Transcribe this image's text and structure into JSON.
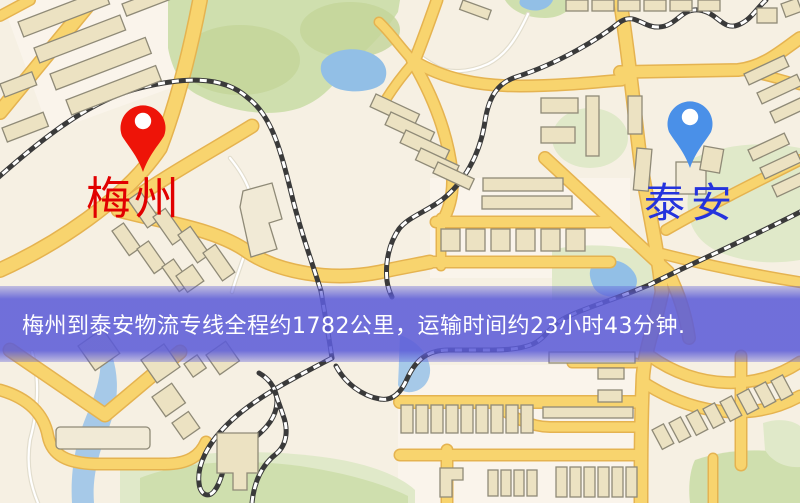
{
  "banner": {
    "text": "梅州到泰安物流专线全程约1782公里，运输时间约23小时43分钟.",
    "background_color": "#5c5cd8",
    "text_color": "#ffffff"
  },
  "markers": {
    "origin": {
      "label": "梅州",
      "label_color": "#e10000",
      "pin_color": "#ee1408",
      "pin_icon": "red-map-pin-icon"
    },
    "destination": {
      "label": "泰安",
      "label_color": "#2433dd",
      "pin_color": "#4a90e8",
      "pin_icon": "blue-map-pin-icon"
    }
  },
  "map_palette": {
    "background": "#f6f0e3",
    "road_fill": "#f8d46e",
    "road_edge": "#e5b350",
    "building": "#ece2c2",
    "park_green": "#cfdfae",
    "water_blue": "#92bfe6",
    "railway_dark": "#3a3a3a"
  }
}
